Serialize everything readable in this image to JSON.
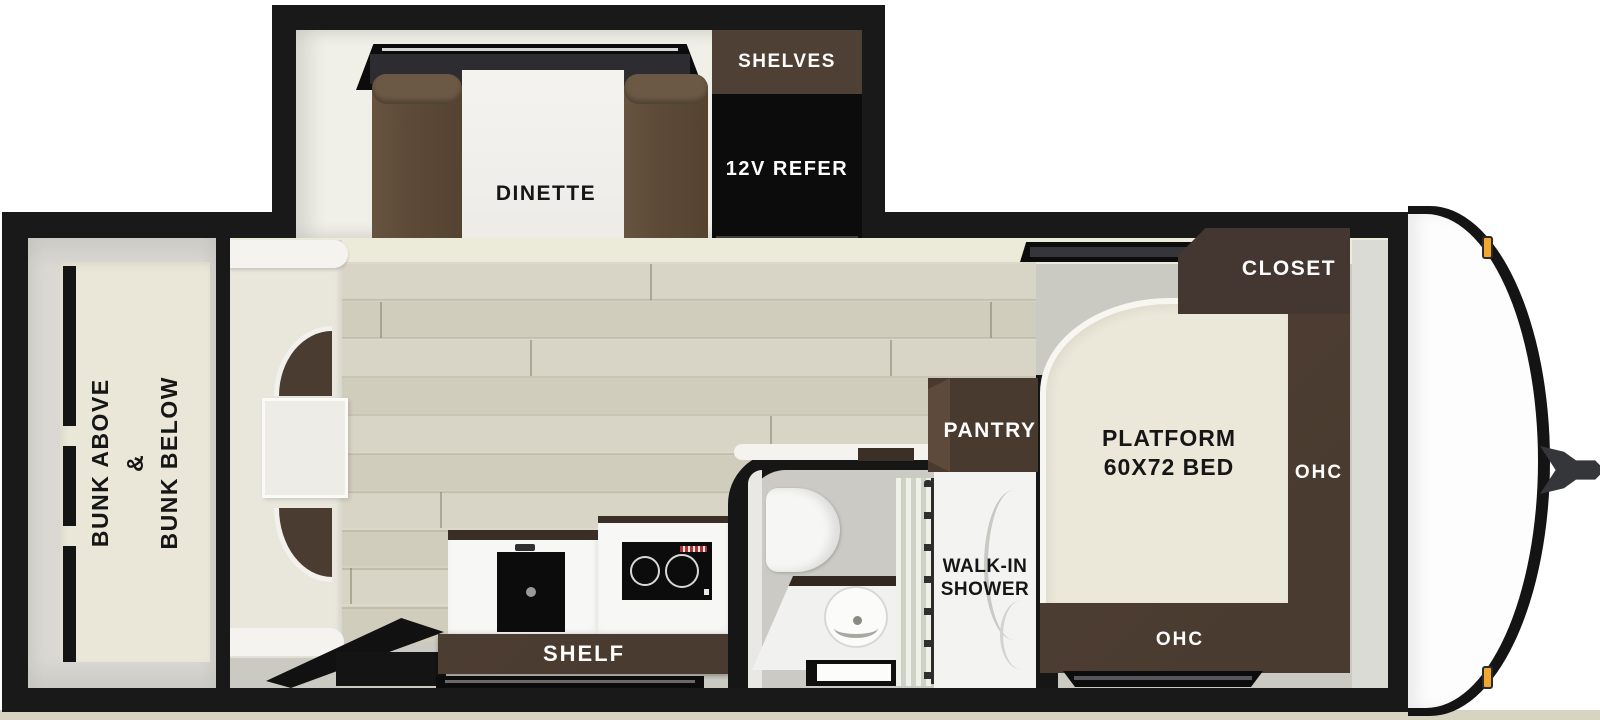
{
  "floorplan": {
    "slide_out": {
      "dinette_label": "DINETTE",
      "shelves_label": "SHELVES",
      "refer_label": "12V REFER"
    },
    "bunk_room": {
      "label_line1": "BUNK ABOVE",
      "label_line2": "&",
      "label_line3": "BUNK BELOW"
    },
    "kitchen": {
      "shelf_label": "SHELF"
    },
    "bathroom": {
      "shower_label_line1": "WALK-IN",
      "shower_label_line2": "SHOWER",
      "pantry_label": "PANTRY"
    },
    "bedroom": {
      "bed_label_line1": "PLATFORM",
      "bed_label_line2": "60X72 BED",
      "closet_label": "CLOSET",
      "ohc_side_label": "OHC",
      "ohc_front_label": "OHC"
    },
    "colors": {
      "wall_black": "#191919",
      "wood_floor": "#d5d2c2",
      "gray_floor": "#cac9c2",
      "mattress_cream": "#eae7d8",
      "cabinet_brown": "#4a3b30",
      "bench_brown": "#5d4a38",
      "appliance_black": "#0c0c0c",
      "counter_white": "#f7f7f5",
      "marker_amber": "#f2a72e",
      "hitch_gray": "#35363a"
    }
  }
}
